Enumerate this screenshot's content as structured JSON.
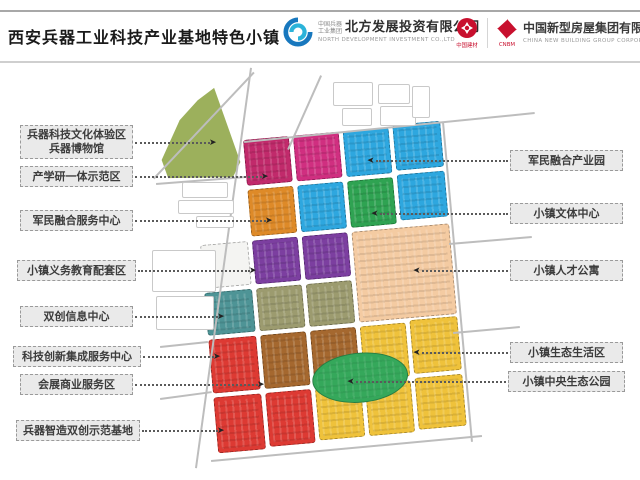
{
  "header": {
    "title": "西安兵器工业科技产业基地特色小镇",
    "logo_north": {
      "group_small_1": "中国兵器",
      "group_small_2": "工业集团",
      "name_cn": "北方发展投资有限公司",
      "name_en": "NORTH DEVELOPMENT INVESTMENT CO.,LTD"
    },
    "logo_cnbm": {
      "mark1_caption": "中国建材",
      "mark2_caption": "CNBM",
      "name_cn": "中国新型房屋集团有限公司",
      "name_en": "CHINA NEW BUILDING GROUP CORPORATION"
    }
  },
  "labels_left": [
    {
      "text": "兵器科技文化体验区\n兵器博物馆",
      "box": {
        "x": 20,
        "y": 125,
        "w": 113,
        "h": 34
      },
      "line_y": 142,
      "x2": 210
    },
    {
      "text": "产学研一体示范区",
      "box": {
        "x": 20,
        "y": 166,
        "w": 113,
        "h": 21
      },
      "line_y": 176,
      "x2": 262
    },
    {
      "text": "军民融合服务中心",
      "box": {
        "x": 20,
        "y": 210,
        "w": 113,
        "h": 21
      },
      "line_y": 220,
      "x2": 266
    },
    {
      "text": "小镇义务教育配套区",
      "box": {
        "x": 17,
        "y": 260,
        "w": 119,
        "h": 21
      },
      "line_y": 270,
      "x2": 250
    },
    {
      "text": "双创信息中心",
      "box": {
        "x": 20,
        "y": 306,
        "w": 113,
        "h": 21
      },
      "line_y": 316,
      "x2": 218
    },
    {
      "text": "科技创新集成服务中心",
      "box": {
        "x": 13,
        "y": 346,
        "w": 128,
        "h": 21
      },
      "line_y": 356,
      "x2": 214
    },
    {
      "text": "会展商业服务区",
      "box": {
        "x": 20,
        "y": 374,
        "w": 113,
        "h": 21
      },
      "line_y": 384,
      "x2": 258
    },
    {
      "text": "兵器智造双创示范基地",
      "box": {
        "x": 16,
        "y": 420,
        "w": 124,
        "h": 21
      },
      "line_y": 430,
      "x2": 218
    }
  ],
  "labels_right": [
    {
      "text": "军民融合产业园",
      "box": {
        "x": 510,
        "y": 150,
        "w": 113,
        "h": 21
      },
      "line_y": 160,
      "x2": 370
    },
    {
      "text": "小镇文体中心",
      "box": {
        "x": 510,
        "y": 203,
        "w": 113,
        "h": 21
      },
      "line_y": 213,
      "x2": 374
    },
    {
      "text": "小镇人才公寓",
      "box": {
        "x": 510,
        "y": 260,
        "w": 113,
        "h": 21
      },
      "line_y": 270,
      "x2": 416
    },
    {
      "text": "小镇生态生活区",
      "box": {
        "x": 510,
        "y": 342,
        "w": 113,
        "h": 21
      },
      "line_y": 352,
      "x2": 416
    },
    {
      "text": "小镇中央生态公园",
      "box": {
        "x": 508,
        "y": 371,
        "w": 117,
        "h": 21
      },
      "line_y": 381,
      "x2": 350
    }
  ],
  "map": {
    "park_color": "#9CB05C",
    "colors": {
      "magenta": "#C12A6B",
      "pink": "#D02F80",
      "blue": "#2EA7DF",
      "orange": "#DE8A28",
      "green": "#2FA352",
      "purple": "#7C3FA0",
      "peach": "#F4CBA2",
      "teal": "#4E9496",
      "olive": "#9C9B6F",
      "red": "#DD3A33",
      "brown": "#A5682F",
      "yellow": "#EFC23B",
      "park_green": "#35A85B"
    },
    "blocks": [
      {
        "name": "industry-academia-demo-block-1",
        "color": "#C12A6B",
        "u": 0,
        "v": 0,
        "w": 46,
        "h": 46
      },
      {
        "name": "industry-academia-demo-block-2",
        "color": "#D02F80",
        "u": 50,
        "v": 0,
        "w": 46,
        "h": 46
      },
      {
        "name": "civil-military-industry-park-block-1",
        "color": "#2EA7DF",
        "u": 100,
        "v": 0,
        "w": 46,
        "h": 46
      },
      {
        "name": "civil-military-industry-park-block-2",
        "color": "#2EA7DF",
        "u": 150,
        "v": -2,
        "w": 48,
        "h": 46
      },
      {
        "name": "civil-military-service-center-block",
        "color": "#DE8A28",
        "u": 0,
        "v": 50,
        "w": 46,
        "h": 47
      },
      {
        "name": "civil-military-industry-park-block-3",
        "color": "#2EA7DF",
        "u": 50,
        "v": 50,
        "w": 46,
        "h": 47
      },
      {
        "name": "culture-sports-center-block",
        "color": "#2FA352",
        "u": 100,
        "v": 50,
        "w": 46,
        "h": 47
      },
      {
        "name": "civil-military-industry-park-block-4",
        "color": "#2EA7DF",
        "u": 150,
        "v": 48,
        "w": 48,
        "h": 46
      },
      {
        "name": "unlabeled-white-block",
        "color": "#F4F4F2",
        "u": -52,
        "v": 101,
        "w": 48,
        "h": 44,
        "plain": true
      },
      {
        "name": "education-zone-block-1",
        "color": "#7C3FA0",
        "u": 0,
        "v": 101,
        "w": 46,
        "h": 44
      },
      {
        "name": "education-zone-block-2",
        "color": "#7C3FA0",
        "u": 50,
        "v": 101,
        "w": 46,
        "h": 44
      },
      {
        "name": "talent-apartment-block",
        "color": "#F4CBA2",
        "u": 100,
        "v": 101,
        "w": 98,
        "h": 91
      },
      {
        "name": "innovation-info-center-block",
        "color": "#4E9496",
        "u": -52,
        "v": 149,
        "w": 48,
        "h": 43
      },
      {
        "name": "tech-integration-block-1",
        "color": "#9C9B6F",
        "u": 0,
        "v": 149,
        "w": 46,
        "h": 43
      },
      {
        "name": "tech-integration-block-2",
        "color": "#9C9B6F",
        "u": 50,
        "v": 149,
        "w": 46,
        "h": 43
      },
      {
        "name": "tech-innovation-service-block",
        "color": "#DD3A33",
        "u": -52,
        "v": 196,
        "w": 48,
        "h": 54
      },
      {
        "name": "exhibition-commerce-block-1",
        "color": "#A5682F",
        "u": 0,
        "v": 196,
        "w": 46,
        "h": 54
      },
      {
        "name": "exhibition-commerce-block-2",
        "color": "#A5682F",
        "u": 50,
        "v": 196,
        "w": 46,
        "h": 54
      },
      {
        "name": "eco-living-block-1",
        "color": "#EFC23B",
        "u": 100,
        "v": 196,
        "w": 46,
        "h": 54
      },
      {
        "name": "eco-living-block-2",
        "color": "#EFC23B",
        "u": 150,
        "v": 194,
        "w": 48,
        "h": 54
      },
      {
        "name": "weapons-smart-mfg-block-1",
        "color": "#DD3A33",
        "u": -52,
        "v": 254,
        "w": 48,
        "h": 56
      },
      {
        "name": "weapons-smart-mfg-block-2",
        "color": "#DD3A33",
        "u": 0,
        "v": 254,
        "w": 46,
        "h": 54
      },
      {
        "name": "eco-living-block-3",
        "color": "#EFC23B",
        "u": 50,
        "v": 254,
        "w": 46,
        "h": 52
      },
      {
        "name": "eco-living-block-4",
        "color": "#EFC23B",
        "u": 100,
        "v": 254,
        "w": 46,
        "h": 52
      },
      {
        "name": "eco-living-block-5",
        "color": "#EFC23B",
        "u": 150,
        "v": 252,
        "w": 48,
        "h": 52
      },
      {
        "name": "central-eco-park",
        "color": "#35A85B",
        "u": 48,
        "v": 222,
        "w": 96,
        "h": 50,
        "shape": "ellipse"
      }
    ],
    "roads": [
      {
        "x1": 252,
        "y1": 68,
        "x2": 197,
        "y2": 468
      },
      {
        "x1": 244,
        "y1": 141,
        "x2": 535,
        "y2": 112
      },
      {
        "x1": 444,
        "y1": 122,
        "x2": 473,
        "y2": 442
      },
      {
        "x1": 211,
        "y1": 460,
        "x2": 482,
        "y2": 435
      },
      {
        "x1": 449,
        "y1": 243,
        "x2": 532,
        "y2": 236
      },
      {
        "x1": 453,
        "y1": 332,
        "x2": 520,
        "y2": 326
      },
      {
        "x1": 160,
        "y1": 398,
        "x2": 212,
        "y2": 391
      },
      {
        "x1": 160,
        "y1": 346,
        "x2": 208,
        "y2": 341
      },
      {
        "x1": 153,
        "y1": 178,
        "x2": 253,
        "y2": 72
      },
      {
        "x1": 156,
        "y1": 183,
        "x2": 246,
        "y2": 176
      },
      {
        "x1": 322,
        "y1": 76,
        "x2": 289,
        "y2": 150
      }
    ],
    "sketches": [
      {
        "x": 333,
        "y": 82,
        "w": 38,
        "h": 22
      },
      {
        "x": 378,
        "y": 84,
        "w": 30,
        "h": 18
      },
      {
        "x": 342,
        "y": 108,
        "w": 28,
        "h": 16
      },
      {
        "x": 380,
        "y": 106,
        "w": 34,
        "h": 18
      },
      {
        "x": 412,
        "y": 86,
        "w": 16,
        "h": 30
      },
      {
        "x": 182,
        "y": 182,
        "w": 44,
        "h": 14
      },
      {
        "x": 178,
        "y": 200,
        "w": 54,
        "h": 12
      },
      {
        "x": 196,
        "y": 216,
        "w": 36,
        "h": 10
      },
      {
        "x": 152,
        "y": 250,
        "w": 62,
        "h": 40
      },
      {
        "x": 156,
        "y": 296,
        "w": 56,
        "h": 32
      }
    ]
  }
}
